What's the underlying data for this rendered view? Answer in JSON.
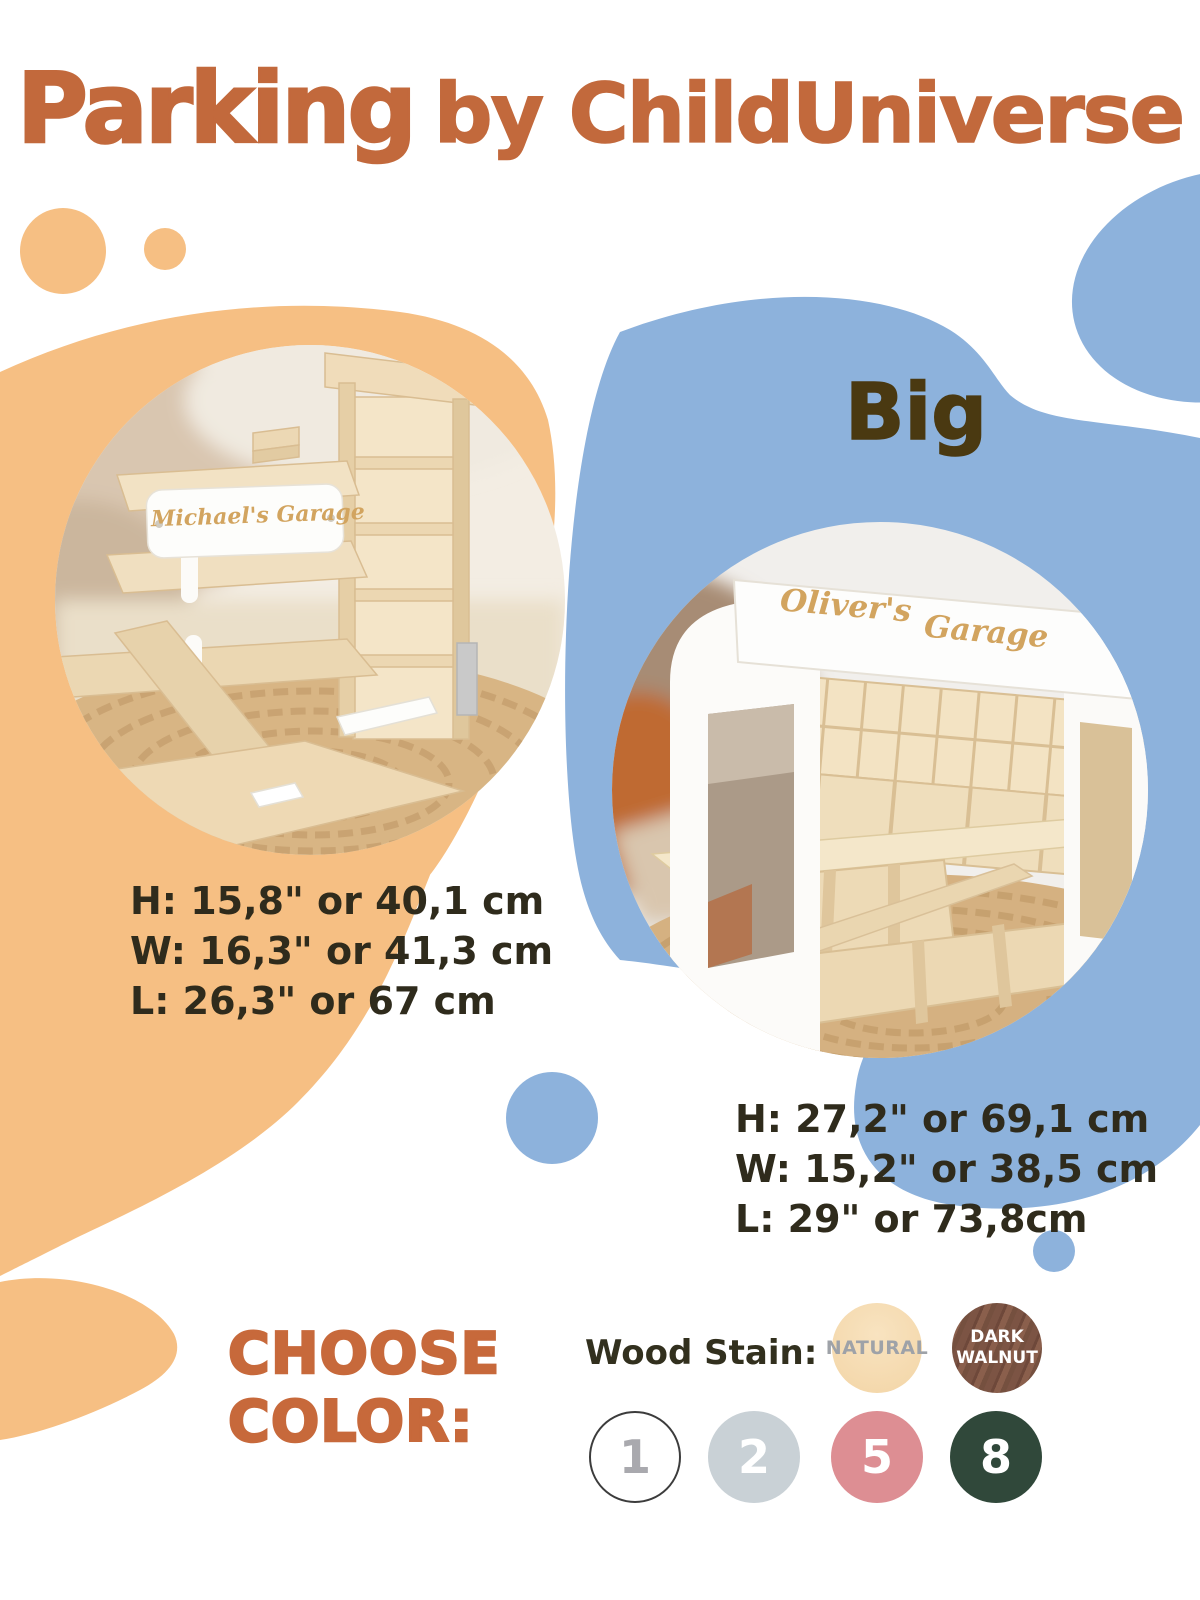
{
  "header": {
    "product_name": "Parking",
    "brand_suffix": "by ChildUniverse"
  },
  "big_label": "Big",
  "products": {
    "small": {
      "sign_text": "Michael's Garage",
      "dimensions": [
        "H: 15,8\" or 40,1 cm",
        "W: 16,3\" or 41,3 cm",
        "L: 26,3\" or 67 cm"
      ]
    },
    "big": {
      "sign_text_left": "Oliver's",
      "sign_text_right": "Garage",
      "dimensions": [
        "H: 27,2\" or 69,1 cm",
        "W: 15,2\" or 38,5 cm",
        "L: 29\" or 73,8cm"
      ]
    }
  },
  "color_picker": {
    "heading": [
      "CHOOSE",
      "COLOR:"
    ],
    "wood_stain_label": "Wood Stain:",
    "stains": [
      {
        "name": "NATURAL",
        "bg": "#F6DCB2",
        "text_color": "#9EA2A8"
      },
      {
        "name": "DARK WALNUT",
        "bg": "#7C5444",
        "text_color": "#FFFFFF"
      }
    ],
    "options": [
      {
        "number": "1",
        "bg": "#FFFFFF",
        "text_color": "#A9A9AE",
        "border": "#3C3C3C"
      },
      {
        "number": "2",
        "bg": "#C9D1D6",
        "text_color": "#FFFFFF"
      },
      {
        "number": "5",
        "bg": "#DD8E93",
        "text_color": "#FFFFFF"
      },
      {
        "number": "8",
        "bg": "#30483A",
        "text_color": "#FFFFFF"
      }
    ]
  },
  "colors": {
    "accent_orange": "#C2693C",
    "blob_orange": "#F6BF83",
    "blob_blue": "#8DB2DC",
    "dimensions_text": "#2F2B1C",
    "big_label_text": "#4A3911",
    "sign_script_gold": "#D2A45F"
  }
}
